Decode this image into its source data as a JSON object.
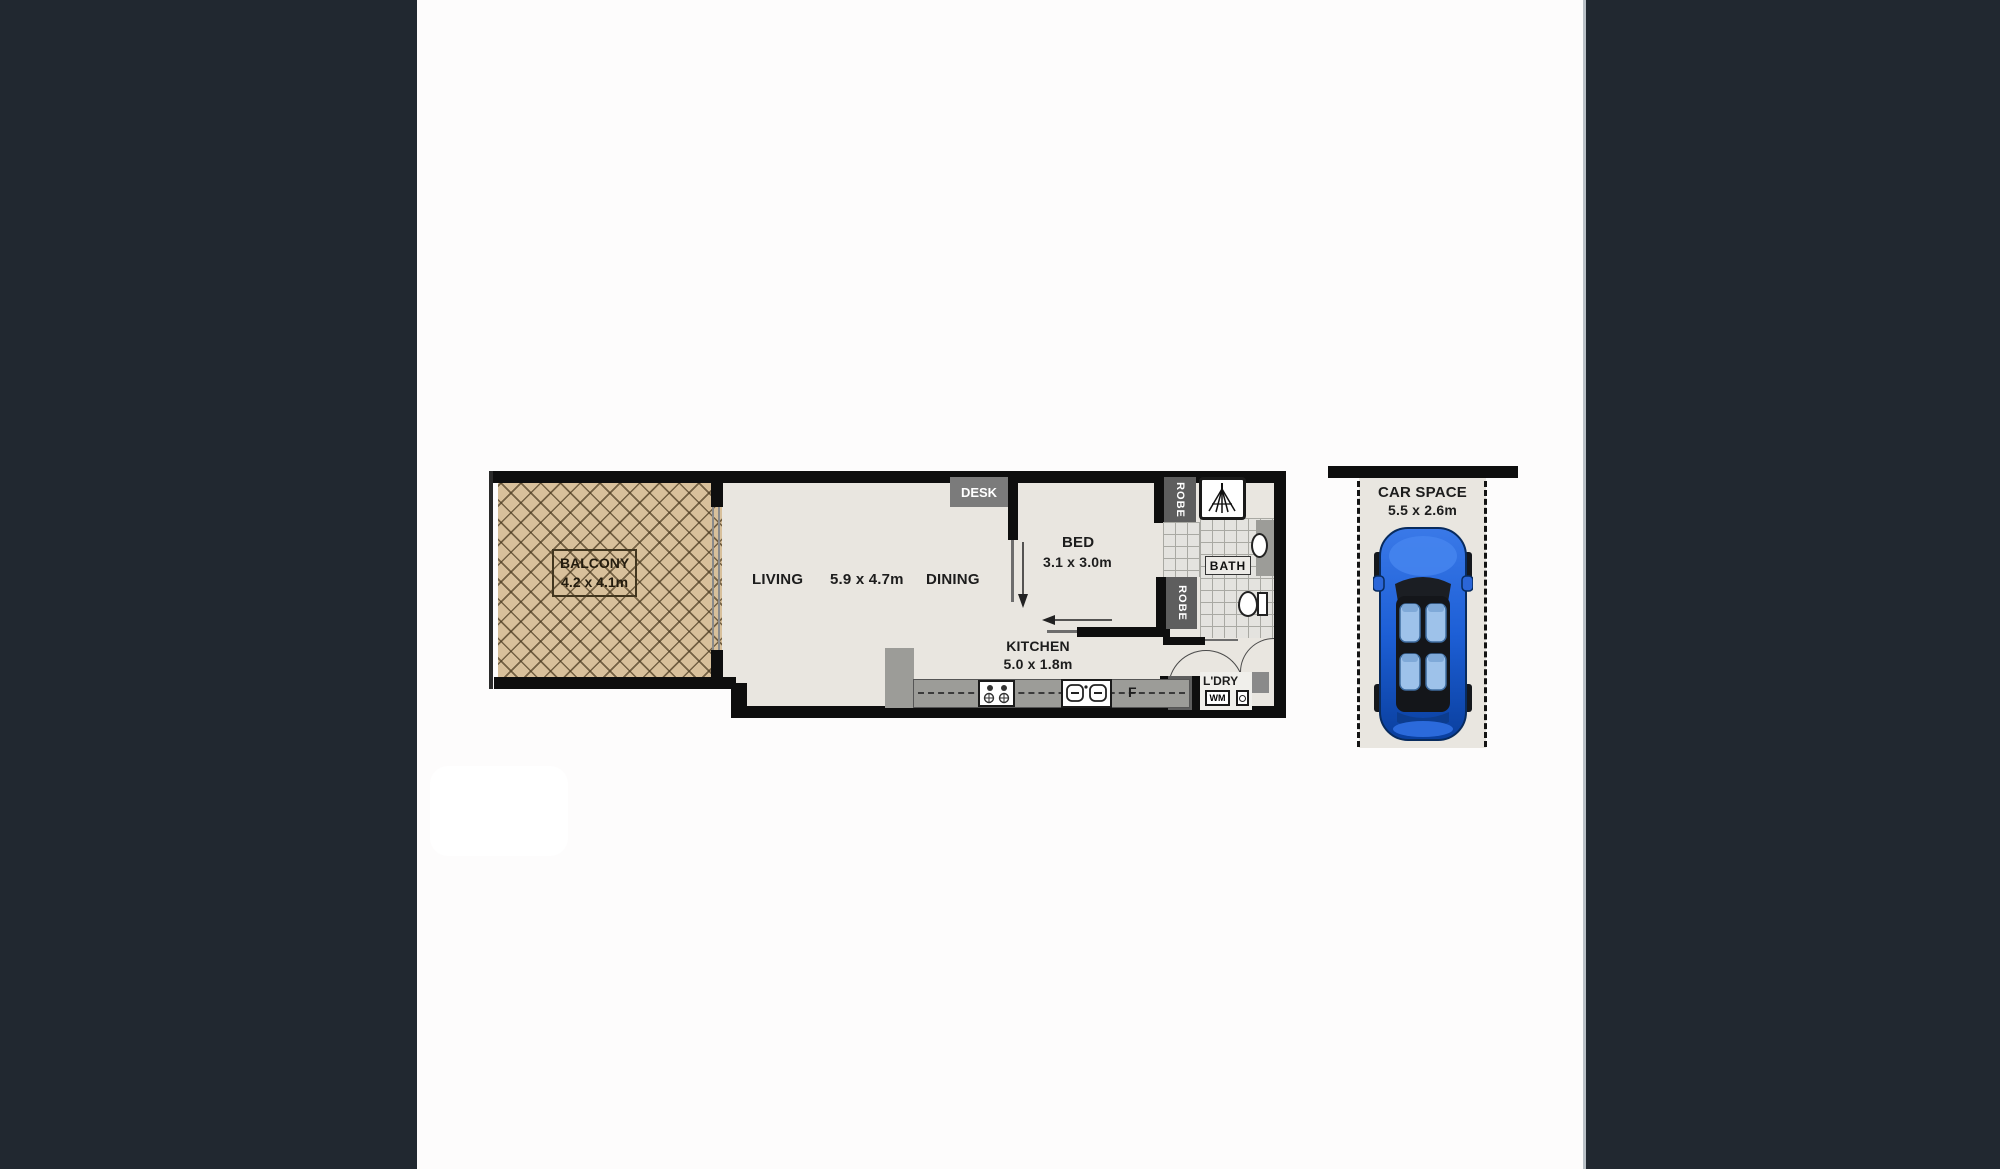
{
  "colors": {
    "page_bg": "#212830",
    "panel_bg": "#fdfcfc",
    "floor": "#e9e6e0",
    "balcony_tan": "#d8c09b",
    "wall_black": "#0e0e0e",
    "fixture_gray": "#9c9c98",
    "label_dark_gray": "#5e5e5e",
    "car_blue": "#1d5fd6"
  },
  "floorplan": {
    "balcony": {
      "name": "BALCONY",
      "dims": "4.2 x 4.1m"
    },
    "living": {
      "name": "LIVING"
    },
    "living_dining_dims": "5.9 x 4.7m",
    "dining": {
      "name": "DINING"
    },
    "desk": {
      "name": "DESK"
    },
    "bed": {
      "name": "BED",
      "dims": "3.1 x 3.0m"
    },
    "robe_top": {
      "name": "ROBE"
    },
    "robe_bottom": {
      "name": "ROBE"
    },
    "bath": {
      "name": "BATH"
    },
    "kitchen": {
      "name": "KITCHEN",
      "dims": "5.0 x 1.8m"
    },
    "fridge": {
      "name": "F"
    },
    "pantry": {
      "name": "P"
    },
    "laundry": {
      "name": "L'DRY",
      "washing_machine": "WM"
    }
  },
  "car_space": {
    "name": "CAR SPACE",
    "dims": "5.5 x 2.6m"
  }
}
